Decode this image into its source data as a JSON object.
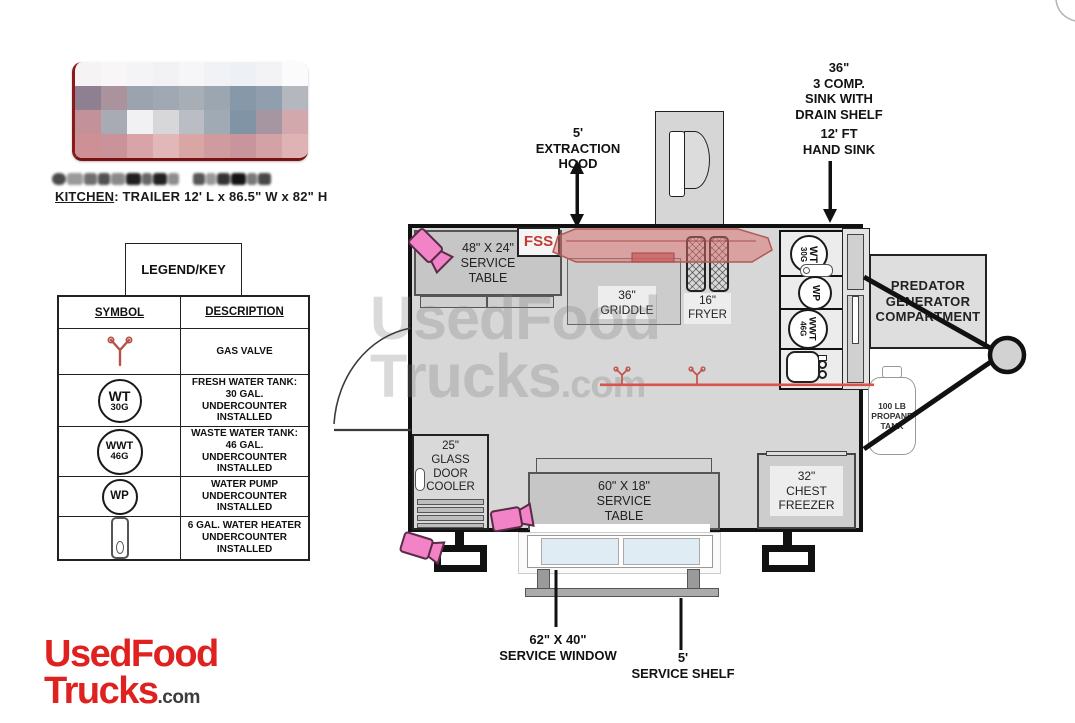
{
  "header": {
    "kitchen_label": "KITCHEN",
    "kitchen_spec": ": TRAILER 12' L x 86.5\" W x 82\" H"
  },
  "legend": {
    "title": "LEGEND/KEY",
    "columns": {
      "symbol": "SYMBOL",
      "description": "DESCRIPTION"
    },
    "rows": [
      {
        "symbol_name": "gas-valve-icon",
        "description": "GAS VALVE"
      },
      {
        "symbol_name": "fresh-water-tank-symbol",
        "circle_main": "WT",
        "circle_sub": "30G",
        "description": "FRESH WATER TANK:\n30 GAL.\nUNDERCOUNTER\nINSTALLED"
      },
      {
        "symbol_name": "waste-water-tank-symbol",
        "circle_main": "WWT",
        "circle_sub": "46G",
        "description": "WASTE WATER TANK:\n46 GAL.\nUNDERCOUNTER\nINSTALLED"
      },
      {
        "symbol_name": "water-pump-symbol",
        "circle_main": "WP",
        "description": "WATER PUMP\nUNDERCOUNTER\nINSTALLED"
      },
      {
        "symbol_name": "water-heater-symbol",
        "description": "6 GAL. WATER HEATER\nUNDERCOUNTER\nINSTALLED"
      }
    ]
  },
  "plan": {
    "labels": {
      "extraction_hood": "5'\nEXTRACTION\nHOOD",
      "comp_sink": "36\"\n3 COMP.\nSINK WITH\nDRAIN SHELF",
      "hand_sink": "12' FT\nHAND SINK",
      "service_window": "62\" X 40\"\nSERVICE WINDOW",
      "service_shelf": "5'\nSERVICE SHELF"
    },
    "equipment": {
      "fss": "FSS",
      "service_table_top": "48\" X 24\"\nSERVICE\nTABLE",
      "griddle": "36\"\nGRIDDLE",
      "fryer": "16\"\nFRYER",
      "wt": {
        "main": "WT",
        "sub": "30G"
      },
      "wp": {
        "main": "WP"
      },
      "wwt": {
        "main": "WWT",
        "sub": "46G"
      },
      "generator": "PREDATOR\nGENERATOR\nCOMPARTMENT",
      "propane": "100 LB\nPROPANE\nTANK",
      "cooler": "25\"\nGLASS\nDOOR\nCOOLER",
      "service_table_bottom": "60\" X 18\"\nSERVICE\nTABLE",
      "freezer": "32\"\nCHEST\nFREEZER"
    }
  },
  "branding": {
    "watermark_word1": "UsedFood",
    "watermark_word2": "Trucks",
    "watermark_suffix": ".com",
    "footer_word1": "UsedFood",
    "footer_word2": "Trucks",
    "footer_suffix": ".com",
    "brand_red": "#df221f"
  },
  "colors": {
    "camera_pink": "#f283c6",
    "hood_red": "#dd6c6c",
    "gas_line_red": "#d9534a",
    "fss_red": "#c13b34",
    "floor_gray": "#d7d7d7"
  },
  "redacted": {
    "logo_mosaic": [
      [
        "#f6f3f4",
        "#f8f6f6",
        "#f4f3f5",
        "#f2f2f5",
        "#f6f6f8",
        "#f1f2f5",
        "#edf0f4",
        "#f3f3f6",
        "#fcfbfb"
      ],
      [
        "#8e8090",
        "#aa939d",
        "#9aa3ae",
        "#a0a9b3",
        "#a8aeb6",
        "#9ba6b1",
        "#8799a9",
        "#909ead",
        "#b4b8be"
      ],
      [
        "#c3919a",
        "#a8abb4",
        "#f1f0f2",
        "#d7d6d9",
        "#babdc3",
        "#a0aab4",
        "#8094a6",
        "#a596a1",
        "#d3a8ac"
      ],
      [
        "#cd9094",
        "#ca9399",
        "#d9a4a7",
        "#e2b7b7",
        "#d9a6a6",
        "#d09b9e",
        "#c9959c",
        "#d2a2a5",
        "#dfb3b3"
      ]
    ],
    "text_segments": [
      {
        "c": "#4a4a4a",
        "w": 14
      },
      {
        "c": "#9a9a9a",
        "w": 16
      },
      {
        "c": "#6f6f6f",
        "w": 13
      },
      {
        "c": "#515151",
        "w": 12
      },
      {
        "c": "#8a8a8a",
        "w": 14
      },
      {
        "c": "#1f1f1f",
        "w": 15
      },
      {
        "c": "#666666",
        "w": 10
      },
      {
        "c": "#222222",
        "w": 14
      },
      {
        "c": "#8d8d8d",
        "w": 11
      },
      {
        "c": "transparent",
        "w": 12
      },
      {
        "c": "#565656",
        "w": 12
      },
      {
        "c": "#999999",
        "w": 10
      },
      {
        "c": "#333333",
        "w": 13
      },
      {
        "c": "#141414",
        "w": 15
      },
      {
        "c": "#787878",
        "w": 10
      },
      {
        "c": "#474747",
        "w": 13
      }
    ]
  }
}
